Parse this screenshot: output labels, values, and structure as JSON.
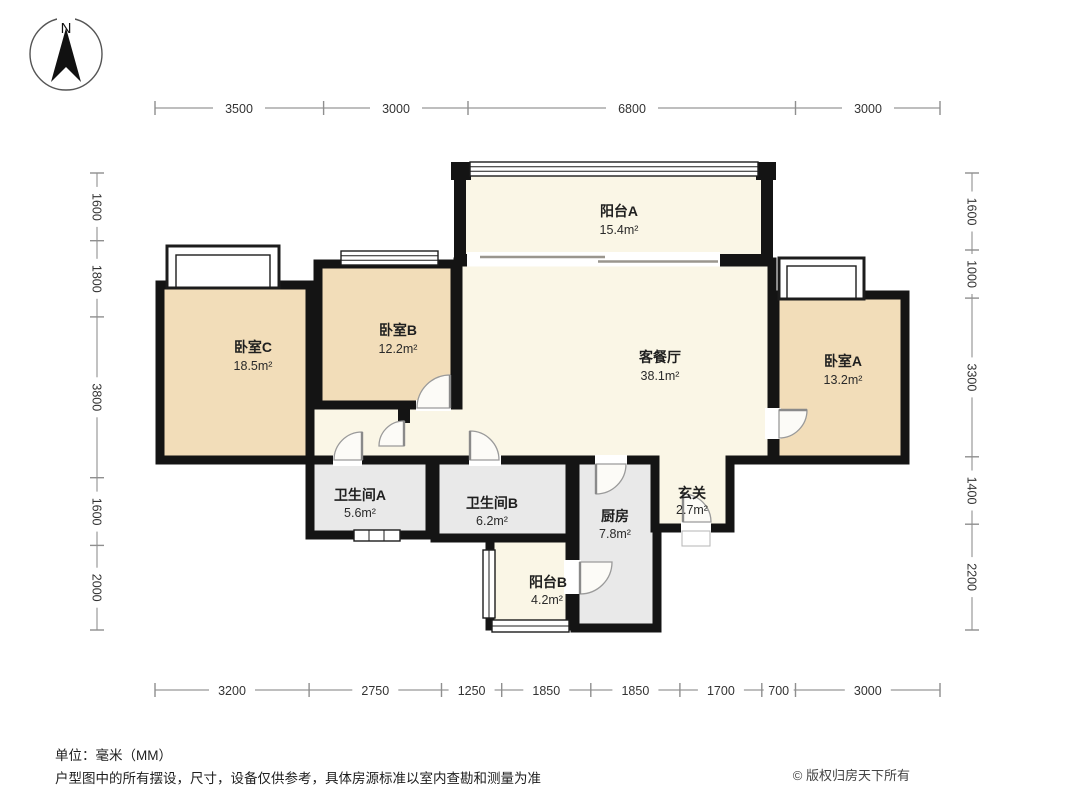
{
  "compass": {
    "label": "N"
  },
  "rooms": [
    {
      "id": "balcony-a",
      "name": "阳台A",
      "area": "15.4m²"
    },
    {
      "id": "bedroom-c",
      "name": "卧室C",
      "area": "18.5m²"
    },
    {
      "id": "bedroom-b",
      "name": "卧室B",
      "area": "12.2m²"
    },
    {
      "id": "living-dining",
      "name": "客餐厅",
      "area": "38.1m²"
    },
    {
      "id": "bedroom-a",
      "name": "卧室A",
      "area": "13.2m²"
    },
    {
      "id": "bath-a",
      "name": "卫生间A",
      "area": "5.6m²"
    },
    {
      "id": "bath-b",
      "name": "卫生间B",
      "area": "6.2m²"
    },
    {
      "id": "kitchen",
      "name": "厨房",
      "area": "7.8m²"
    },
    {
      "id": "entry",
      "name": "玄关",
      "area": "2.7m²"
    },
    {
      "id": "balcony-b",
      "name": "阳台B",
      "area": "4.2m²"
    }
  ],
  "dimensions": {
    "top": [
      "3500",
      "3000",
      "6800",
      "3000"
    ],
    "bottom": [
      "3200",
      "2750",
      "1250",
      "1850",
      "1850",
      "1700",
      "700",
      "3000"
    ],
    "left": [
      "1600",
      "1800",
      "3800",
      "1600",
      "2000"
    ],
    "right": [
      "1600",
      "1000",
      "3300",
      "1400",
      "2200"
    ]
  },
  "footer": {
    "unit_note": "单位：毫米（MM）",
    "disclaimer": "户型图中的所有摆设，尺寸，设备仅供参考，具体房源标准以室内查勘和测量为准",
    "copyright": "© 版权归房天下所有"
  },
  "colors": {
    "bedroom_fill": "#f2ddb9",
    "living_fill": "#faf6e6",
    "utility_fill": "#e9e9e9",
    "wall": "#141414",
    "dimension_line": "#a8a8a8"
  }
}
